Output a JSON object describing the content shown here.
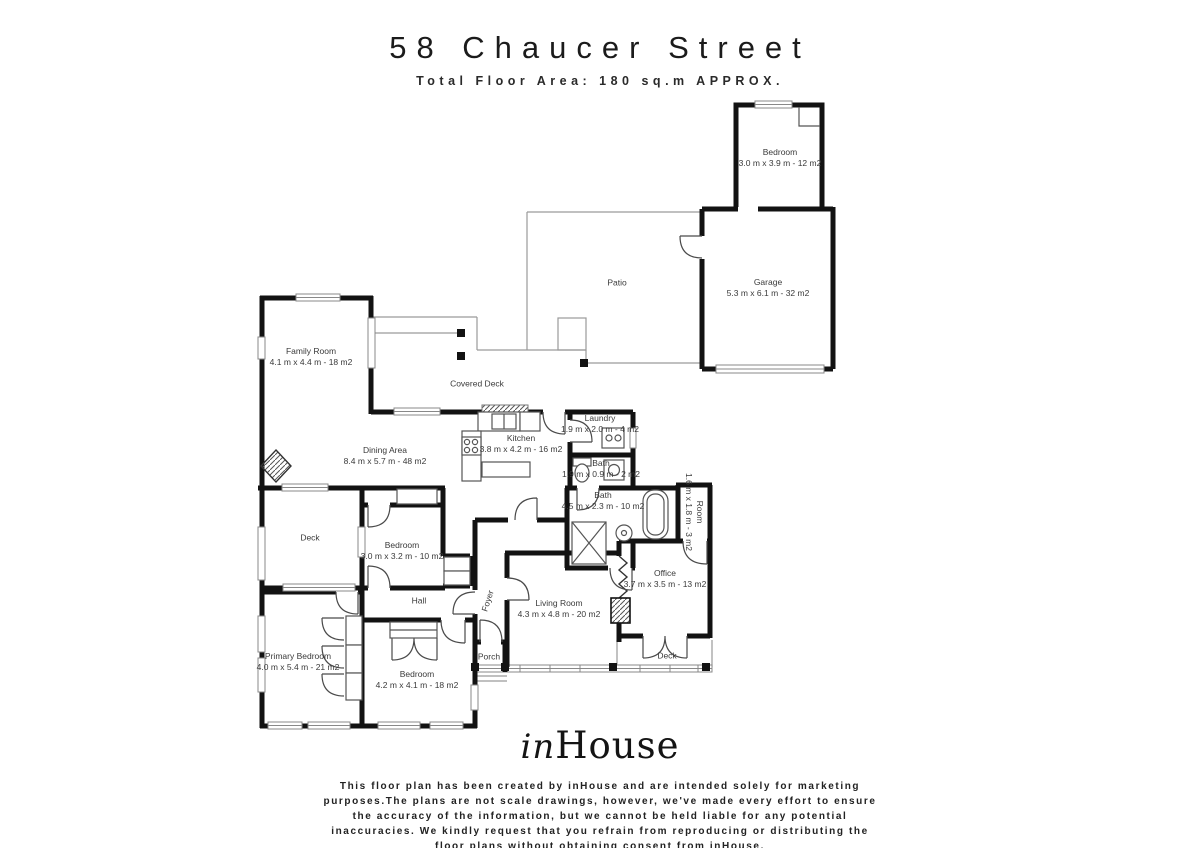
{
  "header": {
    "title": "58 Chaucer Street",
    "subtitle": "Total Floor Area: 180 sq.m APPROX."
  },
  "rooms": {
    "bedroom_top": {
      "name": "Bedroom",
      "dims": "3.0 m x 3.9 m - 12 m2"
    },
    "garage": {
      "name": "Garage",
      "dims": "5.3 m x 6.1 m - 32 m2"
    },
    "patio": {
      "name": "Patio"
    },
    "family_room": {
      "name": "Family Room",
      "dims": "4.1 m x 4.4 m - 18 m2"
    },
    "covered_deck": {
      "name": "Covered Deck"
    },
    "dining_area": {
      "name": "Dining Area",
      "dims": "8.4 m x 5.7 m - 48 m2"
    },
    "kitchen": {
      "name": "Kitchen",
      "dims": "3.8 m x 4.2 m - 16 m2"
    },
    "laundry": {
      "name": "Laundry",
      "dims": "1.9 m x 2.0 m - 4 m2"
    },
    "bath_small": {
      "name": "Bath",
      "dims": "1.9 m x 0.9 m - 2 m2"
    },
    "bath_main": {
      "name": "Bath",
      "dims": "4.5 m x 2.3 m - 10 m2"
    },
    "room_small": {
      "name": "Room",
      "dims": "1.6 m x 1.8 m - 3 m2"
    },
    "deck_left": {
      "name": "Deck"
    },
    "bedroom_mid": {
      "name": "Bedroom",
      "dims": "3.0 m x 3.2 m - 10 m2"
    },
    "hall": {
      "name": "Hall"
    },
    "foyer": {
      "name": "Foyer"
    },
    "living_room": {
      "name": "Living Room",
      "dims": "4.3 m x 4.8 m - 20 m2"
    },
    "office": {
      "name": "Office",
      "dims": "3.7 m x 3.5 m - 13 m2"
    },
    "deck_right": {
      "name": "Deck"
    },
    "porch": {
      "name": "Porch"
    },
    "primary_bedroom": {
      "name": "Primary Bedroom",
      "dims": "4.0 m x 5.4 m - 21 m2"
    },
    "bedroom_bottom": {
      "name": "Bedroom",
      "dims": "4.2 m x 4.1 m - 18 m2"
    }
  },
  "footer": {
    "logo_script": "in",
    "logo_serif": "House",
    "disclaimer": "This floor plan has been created by inHouse and are intended solely for marketing\npurposes.The plans are not scale drawings, however, we've made every effort to ensure\nthe accuracy of the information, but we cannot be held liable for any potential\ninaccuracies. We kindly request that you refrain from reproducing or distributing the\nfloor plans without obtaining consent from inHouse."
  },
  "colors": {
    "wall": "#121212",
    "thin_line": "#9a9a9a",
    "label_text": "#3a3a3a"
  }
}
